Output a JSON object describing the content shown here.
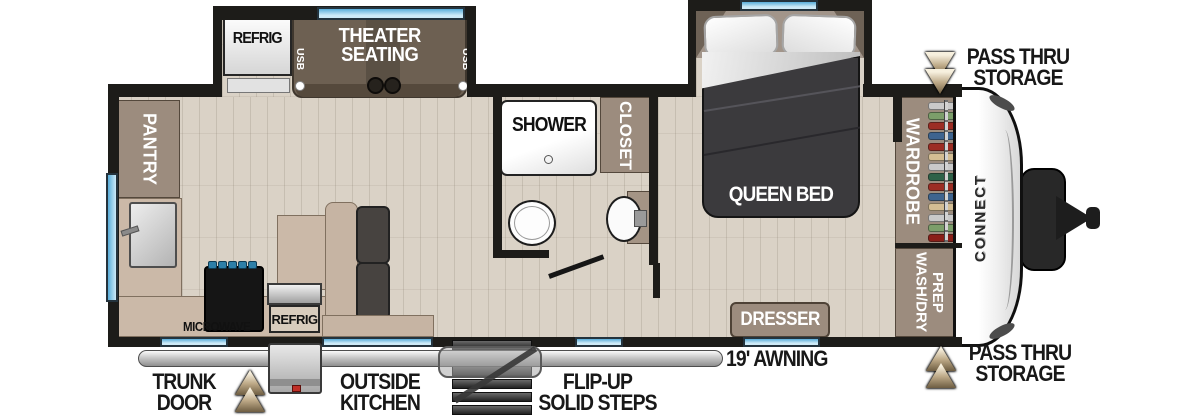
{
  "floorplan": {
    "brand": "CONNECT",
    "slideouts": {
      "refrig_label": "REFRIG",
      "theater_label": "THEATER\nSEATING",
      "usb_left": "USB",
      "usb_right": "USB",
      "queen_bed_label": "QUEEN BED"
    },
    "rooms": {
      "pantry": "PANTRY",
      "shower": "SHOWER",
      "closet": "CLOSET",
      "wardrobe": "WARDROBE",
      "wash_dry_prep": "WASH/DRY\nPREP",
      "dresser": "DRESSER",
      "microwave": "MICROWAVE",
      "outside_refrig": "REFRIG"
    },
    "exterior": {
      "trunk_door": "TRUNK\nDOOR",
      "outside_kitchen": "OUTSIDE\nKITCHEN",
      "flip_up_steps": "FLIP-UP\nSOLID STEPS",
      "awning": "19' AWNING",
      "pass_thru_top": "PASS THRU\nSTORAGE",
      "pass_thru_bottom": "PASS THRU\nSTORAGE"
    },
    "colors": {
      "wall": "#1d1c19",
      "wood_floor": "#dad2c6",
      "cabinet_brown": "#9c8c7e",
      "counter_tan": "#cbb9a8",
      "window_blue": "#8ec9e8",
      "sofa_brown": "#6d6052",
      "cushion_dark": "#474340",
      "bed_charcoal": "#3b3a3d",
      "arrow_tan": "#bca886",
      "accent_red": "#c03028"
    },
    "wardrobe": {
      "clothes": [
        "#c9c9c9",
        "#7c9e6a",
        "#9c2d24",
        "#3e648f",
        "#9c2d24",
        "#d3bd93",
        "#c9c9c9",
        "#2e6148",
        "#9c2d24",
        "#3e648f",
        "#d3bd93",
        "#c9c9c9",
        "#7c9e6a",
        "#8a1f18"
      ]
    }
  }
}
